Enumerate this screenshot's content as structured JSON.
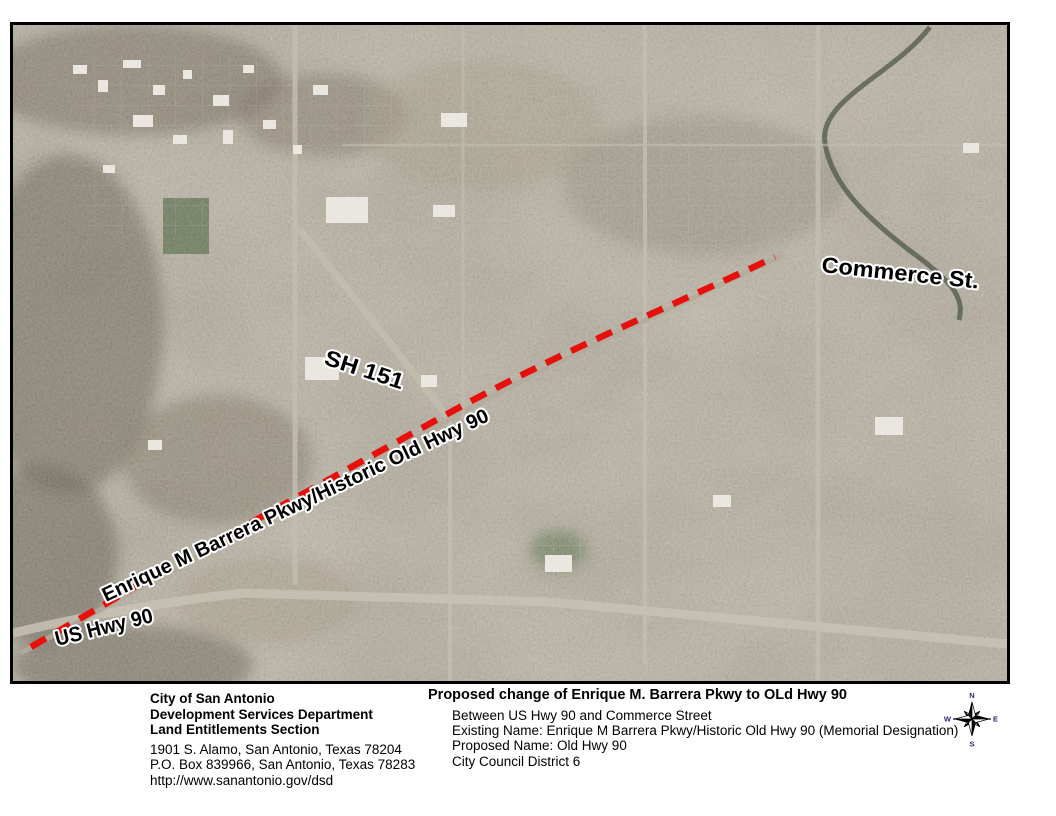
{
  "map": {
    "border_color": "#000000",
    "route_color": "#e8100c",
    "labels": {
      "commerce_st": "Commerce St.",
      "sh_151": "SH 151",
      "enrique_barrera": "Enrique M Barrera Pkwy/Historic Old Hwy 90",
      "us_hwy_90": "US Hwy 90"
    }
  },
  "footer": {
    "agency": {
      "name": "City of San Antonio",
      "department": "Development Services Department",
      "section": "Land Entitlements Section",
      "address_line1": "1901 S. Alamo, San Antonio, Texas 78204",
      "address_line2": "P.O. Box 839966, San Antonio, Texas 78283",
      "website": "http://www.sanantonio.gov/dsd"
    },
    "proposal": {
      "title": "Proposed change of Enrique M. Barrera Pkwy to OLd Hwy 90",
      "extent": "Between US Hwy 90 and Commerce Street",
      "existing_name": "Existing Name: Enrique M Barrera Pkwy/Historic Old Hwy 90 (Memorial Designation)",
      "proposed_name": "Proposed Name: Old Hwy 90",
      "district": "City Council District 6"
    },
    "compass": {
      "north": "N",
      "south": "S",
      "east": "E",
      "west": "W"
    }
  }
}
